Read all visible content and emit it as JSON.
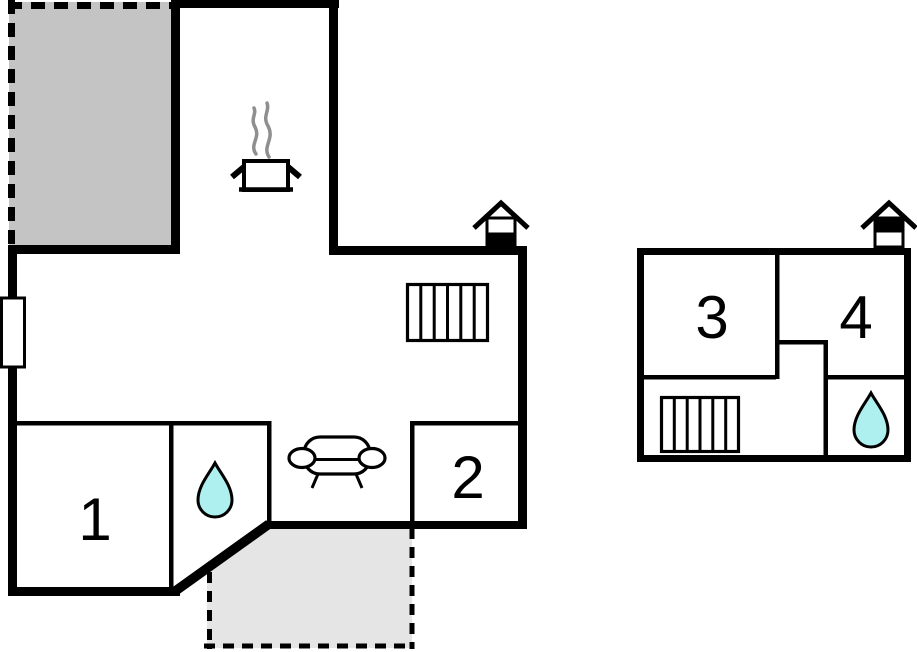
{
  "figure": {
    "kind": "floor-plan",
    "background": "#ffffff"
  },
  "left_plan": {
    "name": "ground-floor",
    "rooms": [
      {
        "label": "1"
      },
      {
        "label": "2"
      }
    ],
    "areas": [
      "upper-terrace",
      "lower-terrace",
      "kitchen",
      "living-room",
      "bathroom"
    ],
    "icons": [
      "window-icon",
      "cooking-pot-icon",
      "steam-icon",
      "stairs-icon",
      "sofa-icon",
      "water-drop-icon",
      "entrance-house-icon"
    ]
  },
  "right_plan": {
    "name": "upper-floor",
    "rooms": [
      {
        "label": "3"
      },
      {
        "label": "4"
      }
    ],
    "areas": [
      "landing",
      "bathroom"
    ],
    "icons": [
      "stairs-icon",
      "water-drop-icon",
      "entrance-house-icon"
    ]
  },
  "colors": {
    "wall": "#000000",
    "upper_terrace_fill": "#c4c4c4",
    "lower_terrace_fill": "#e5e5e5",
    "water_drop_fill": "#aef0f0",
    "steam": "#8f8f8f",
    "background": "#ffffff"
  }
}
